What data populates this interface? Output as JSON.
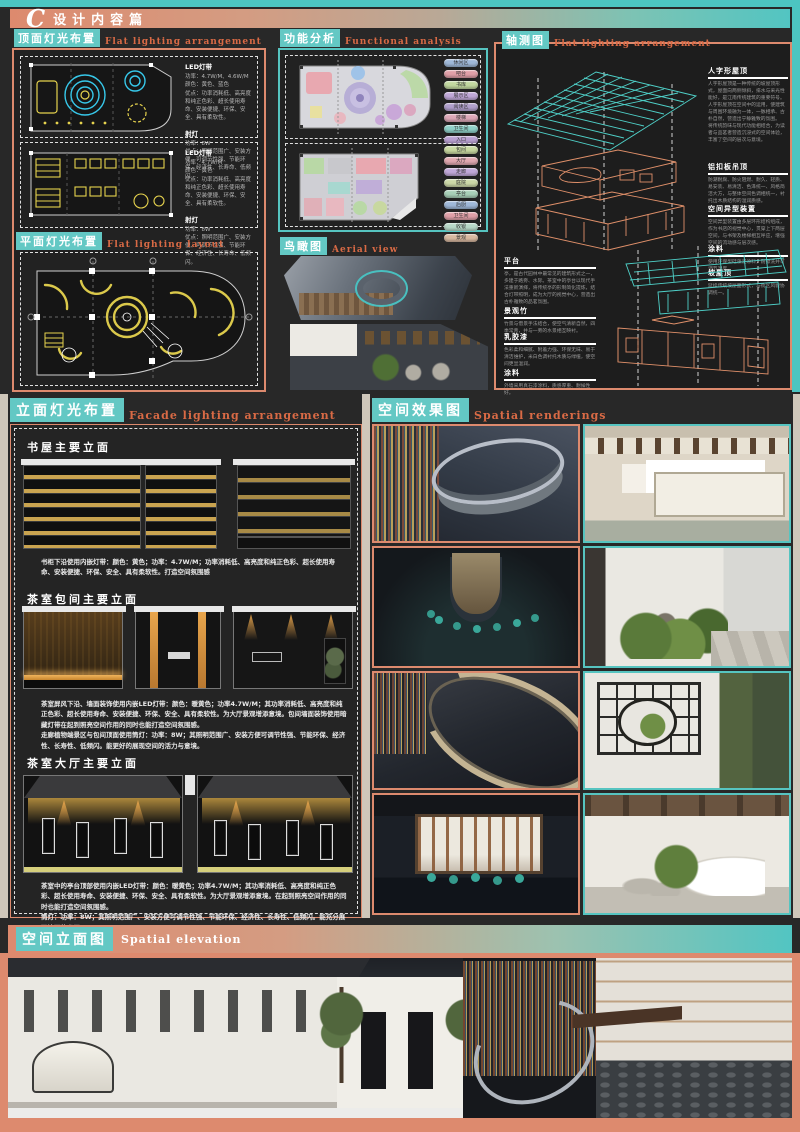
{
  "colors": {
    "accent_teal": "#56c4c0",
    "accent_salmon": "#dd8a6e",
    "cad_cyan": "#37c8ea",
    "cad_yellow": "#e6d34e"
  },
  "header": {
    "letter": "C",
    "title": "设计内容篇"
  },
  "top_lighting": {
    "title": "顶面灯光布置",
    "subtitle": "Flat lighting arrangement",
    "notes_a": [
      {
        "h": "LED灯带",
        "body": "功率：4.7W/M、4.6W/M\n颜色：黄色、蓝色\n优点：功率消耗低、高亮度和纯正色彩、超长使用寿命、安装便捷、环保、安全、具有柔软性。"
      },
      {
        "h": "射灯",
        "body": "功率：8W\n优点：照明范围广、安装方便、可调节性强、节能环保、经济性、长寿命、低频闪。"
      }
    ],
    "notes_b": [
      {
        "h": "LED灯带",
        "body": "功率：4.7W/M\n颜色：黄色\n优点：功率消耗低、高亮度和纯正色彩、超长使用寿命、安装便捷、环保、安全、具有柔软性。"
      },
      {
        "h": "射灯",
        "body": "功率：8W\n优点：照明范围广、安装方便、可调节性强、节能环保、经济性、长寿命、低频闪。"
      }
    ]
  },
  "flat_lighting": {
    "title": "平面灯光布置",
    "subtitle": "Flat lighting layout"
  },
  "functional": {
    "title": "功能分析",
    "subtitle": "Functional analysis",
    "legend_a": [
      "休闲区",
      "吧台",
      "书库",
      "展示区",
      "阅读区",
      "楼梯",
      "卫生间",
      "入口"
    ],
    "legend_b": [
      "包间",
      "大厅",
      "走廊",
      "庭院",
      "亭台",
      "后厨",
      "卫生间",
      "收银",
      "景观"
    ]
  },
  "aerial": {
    "title": "鸟瞰图",
    "subtitle": "Aerial view"
  },
  "axon": {
    "title": "轴测图",
    "subtitle": "Flat lighting arrangement",
    "notes_right": [
      {
        "h": "人字形屋顶",
        "body": "人字形屋顶是一种传统的坡屋顶形式，屋面向两侧倾斜，排水与采光性能好，是江南传统建筑的重要符号。\n人字形屋顶在空间中的运用，使建筑与周围环境融为一体，一脉相承、古朴自然，营造出宁静雅致的氛围。\n将传统韵味与现代功能相结合，为读者与品茗者营造沉浸式的空间体验，丰富了空间的层次与意境。"
      },
      {
        "h": "铝扣板吊顶",
        "body": "防潮耐腐、防火阻燃、耐久、轻质、易安装、易清洁、色泽统一、风格简洁大方，与整体空间色调相统一，衬托出木质结构的温润质感。"
      },
      {
        "h": "空间异型装置",
        "body": "空间异型装置由多层环形结构组成，作为书店的视觉中心，贯穿上下两层空间，与书架及楼梯相互呼应，增强空间的流动感与层次感。"
      },
      {
        "h": "涂料",
        "body": "使用环保型硅藻泥涂料，耐擦洗并可调节湿度。"
      },
      {
        "h": "坡屋顶",
        "body": "延续传统坡屋面形式，与街区风貌协调统一。"
      }
    ],
    "notes_left": [
      {
        "h": "平台",
        "body": "亭，是古代园林中最常见的建筑形式之一，多建于路旁、水际。茶室中的亭台以现代手法重新演绎，将传统亭的形制简化提炼，结合灯带照明，成为大厅的视觉中心，营造出古朴雅致的品茗氛围。"
      },
      {
        "h": "景观竹",
        "body": "竹景与借景手法结合，使空气清新自然，四季常青，并与一旁的水景相互映衬。"
      },
      {
        "h": "乳胶漆",
        "body": "色彩柔和细腻、附着力强、环保无味、易于清洁维护，米白色调衬托木质与绿植，使空间更显温润。"
      },
      {
        "h": "涂料",
        "body": "外墙采用真石漆涂料，质感厚重、耐候性好。"
      }
    ]
  },
  "facade": {
    "title": "立面灯光布置",
    "subtitle": "Facade lighting arrangement",
    "groups": [
      {
        "heading": "书屋主要立面",
        "caption": "书柜下沿使用内嵌灯带：颜色：黄色；功率：4.7W/M；功率消耗低、高亮度和纯正色彩、超长使用寿命、安装便捷、环保、安全、具有柔软性。打造空间氛围感"
      },
      {
        "heading": "茶室包间主要立面",
        "caption": "茶室屏风下沿、墙面装饰使用内嵌LED灯带：颜色：暖黄色；功率4.7W/M；其功率消耗低、高亮度和纯正色彩、超长使用寿命、安装便捷、环保、安全、具有柔软性。为大厅景观增添意境。包间墙面装饰使用暗藏灯带在起到照亮空间作用的同时也能打造空间氛围感。\n走廊植物端景区与包间顶面使用筒灯：功率：8W；其照明范围广、安装方便可调节性强、节能环保、经济性、长寿性、低频闪。能更好的展现空间的活力与意境。"
      },
      {
        "heading": "茶室大厅主要立面",
        "caption": "茶室中的亭台顶部使用内嵌LED灯带：颜色：暖黄色；功率4.7W/M；其功率消耗低、高亮度和纯正色彩、超长使用寿命、安装便捷、环保、安全、具有柔软性。为大厅景观增添意境。在起到照亮空间作用的同时也能打造空间氛围感。\n筒灯：功率：8W；其照明范围广、安装方便可调节性强、节能环保、经济性、长寿性、低频闪。能充分展现墙面的书画。"
      }
    ]
  },
  "renderings": {
    "title": "空间效果图",
    "subtitle": "Spatial renderings"
  },
  "elevation": {
    "title": "空间立面图",
    "subtitle": "Spatial elevation"
  }
}
